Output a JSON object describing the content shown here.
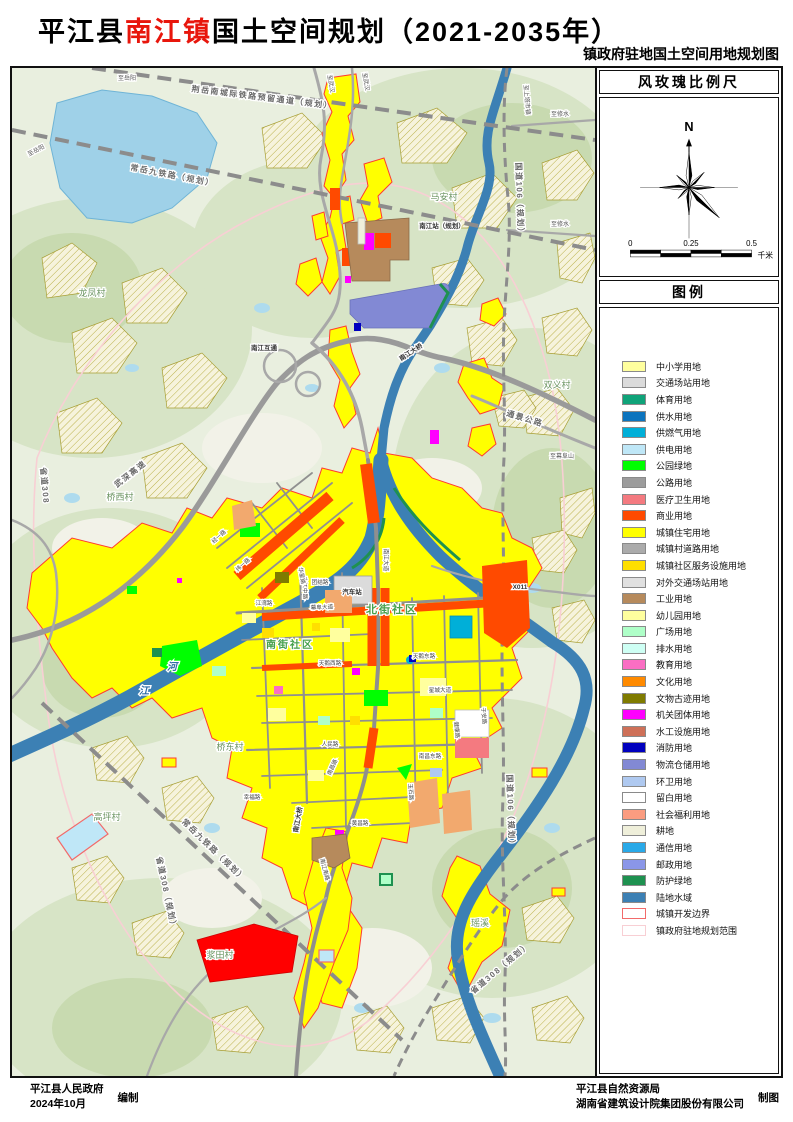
{
  "title": {
    "prefix": "平江县",
    "highlight": "南江镇",
    "suffix": "国土空间规划（2021-2035年）"
  },
  "subtitle": "镇政府驻地国土空间用地规划图",
  "sidebar": {
    "compass_header": "风玫瑰比例尺",
    "north_label": "N",
    "scale": {
      "t0": "0",
      "t1": "0.25",
      "t2": "0.5",
      "unit": "千米"
    },
    "legend_header": "图例",
    "legend_items": [
      {
        "label": "中小学用地",
        "fill": "#FFFF9E"
      },
      {
        "label": "交通场站用地",
        "fill": "#DBDBDB"
      },
      {
        "label": "体育用地",
        "fill": "#0FA379"
      },
      {
        "label": "供水用地",
        "fill": "#0C74BE"
      },
      {
        "label": "供燃气用地",
        "fill": "#00AFD8"
      },
      {
        "label": "供电用地",
        "fill": "#BFE7F7"
      },
      {
        "label": "公园绿地",
        "fill": "#00FF00"
      },
      {
        "label": "公路用地",
        "fill": "#9C9C9C"
      },
      {
        "label": "医疗卫生用地",
        "fill": "#F47A80"
      },
      {
        "label": "商业用地",
        "fill": "#FF4A00"
      },
      {
        "label": "城镇住宅用地",
        "fill": "#FFFF00"
      },
      {
        "label": "城镇村道路用地",
        "fill": "#ABABAB"
      },
      {
        "label": "城镇社区服务设施用地",
        "fill": "#FFDF00"
      },
      {
        "label": "对外交通场站用地",
        "fill": "#E0E0E0"
      },
      {
        "label": "工业用地",
        "fill": "#B68A5C"
      },
      {
        "label": "幼儿园用地",
        "fill": "#FFFF9E"
      },
      {
        "label": "广场用地",
        "fill": "#AFFFC8"
      },
      {
        "label": "排水用地",
        "fill": "#CEFFF4"
      },
      {
        "label": "教育用地",
        "fill": "#FA6EC3"
      },
      {
        "label": "文化用地",
        "fill": "#FF8A00"
      },
      {
        "label": "文物古迹用地",
        "fill": "#7F7B00"
      },
      {
        "label": "机关团体用地",
        "fill": "#FF00FF"
      },
      {
        "label": "水工设施用地",
        "fill": "#CE7058"
      },
      {
        "label": "消防用地",
        "fill": "#0000BE"
      },
      {
        "label": "物流仓储用地",
        "fill": "#8289D4"
      },
      {
        "label": "环卫用地",
        "fill": "#AFC9F0"
      },
      {
        "label": "留白用地",
        "fill": "#FFFFFF"
      },
      {
        "label": "社会福利用地",
        "fill": "#FB9C80"
      },
      {
        "label": "耕地",
        "fill": "#EFEFDA"
      },
      {
        "label": "通信用地",
        "fill": "#29A9E8"
      },
      {
        "label": "邮政用地",
        "fill": "#8A96E8"
      },
      {
        "label": "防护绿地",
        "fill": "#1E9150"
      },
      {
        "label": "陆地水域",
        "fill": "#3C80B4"
      },
      {
        "label": "城镇开发边界",
        "fill": "#FFFFFF",
        "stroke": "#F26A6A"
      },
      {
        "label": "镇政府驻地规划范围",
        "fill": "#FFFFFF",
        "stroke": "#F8CFD4"
      }
    ]
  },
  "footer": {
    "left_org": "平江县人民政府",
    "left_date": "2024年10月",
    "left_role": "编制",
    "right_org1": "平江县自然资源局",
    "right_org2": "湖南省建筑设计院集团股份有限公司",
    "right_role": "制图"
  },
  "map": {
    "labels": [
      {
        "t": "龙凤村",
        "x": 80,
        "y": 228,
        "c": "v"
      },
      {
        "t": "桥西村",
        "x": 108,
        "y": 432,
        "c": "v"
      },
      {
        "t": "马安村",
        "x": 432,
        "y": 132,
        "c": "v"
      },
      {
        "t": "双义村",
        "x": 545,
        "y": 320,
        "c": "v"
      },
      {
        "t": "桥东村",
        "x": 218,
        "y": 682,
        "c": "v"
      },
      {
        "t": "高坪村",
        "x": 95,
        "y": 752,
        "c": "v"
      },
      {
        "t": "浆田村",
        "x": 208,
        "y": 890,
        "c": "v"
      },
      {
        "t": "瑶溪",
        "x": 468,
        "y": 858,
        "c": "v"
      },
      {
        "t": "北街社区",
        "x": 380,
        "y": 545,
        "c": "c"
      },
      {
        "t": "南街社区",
        "x": 278,
        "y": 580,
        "c": "c",
        "s": 10
      },
      {
        "t": "河",
        "x": 160,
        "y": 602,
        "c": "w"
      },
      {
        "t": "江",
        "x": 132,
        "y": 626,
        "c": "w"
      },
      {
        "t": "幕阜大道",
        "x": 310,
        "y": 541,
        "c": "r",
        "r": -2
      },
      {
        "t": "南江大道",
        "x": 372,
        "y": 492,
        "c": "r",
        "r": 90
      },
      {
        "t": "南江中路",
        "x": 291,
        "y": 520,
        "c": "r",
        "r": 88
      },
      {
        "t": "天鹅西路",
        "x": 318,
        "y": 597,
        "c": "r"
      },
      {
        "t": "天鹅东路",
        "x": 412,
        "y": 590,
        "c": "r"
      },
      {
        "t": "星城大道",
        "x": 428,
        "y": 624,
        "c": "r"
      },
      {
        "t": "健康路",
        "x": 443,
        "y": 662,
        "c": "r",
        "r": 85
      },
      {
        "t": "南昌东路",
        "x": 418,
        "y": 690,
        "c": "r"
      },
      {
        "t": "南昌路",
        "x": 322,
        "y": 700,
        "c": "r",
        "r": -65
      },
      {
        "t": "人民路",
        "x": 318,
        "y": 678,
        "c": "r"
      },
      {
        "t": "玉石路",
        "x": 397,
        "y": 724,
        "c": "r",
        "r": 87
      },
      {
        "t": "黄昌路",
        "x": 348,
        "y": 757,
        "c": "r"
      },
      {
        "t": "幸福路",
        "x": 240,
        "y": 731,
        "c": "r"
      },
      {
        "t": "团结路",
        "x": 308,
        "y": 516,
        "c": "r"
      },
      {
        "t": "华星路",
        "x": 288,
        "y": 508,
        "c": "r",
        "r": 80
      },
      {
        "t": "江湾路",
        "x": 252,
        "y": 537,
        "c": "r"
      },
      {
        "t": "经一路",
        "x": 208,
        "y": 470,
        "c": "r",
        "r": -42
      },
      {
        "t": "纬一路",
        "x": 232,
        "y": 498,
        "c": "r",
        "r": -42
      },
      {
        "t": "于安路",
        "x": 470,
        "y": 648,
        "c": "r",
        "r": 85
      },
      {
        "t": "南江南路",
        "x": 311,
        "y": 802,
        "c": "r",
        "r": 75
      },
      {
        "t": "汽车站",
        "x": 340,
        "y": 526,
        "c": "t"
      },
      {
        "t": "南江站（规划）",
        "x": 430,
        "y": 160,
        "c": "t"
      },
      {
        "t": "南江互通",
        "x": 252,
        "y": 282,
        "c": "t"
      },
      {
        "t": "南江大桥",
        "x": 400,
        "y": 286,
        "c": "t",
        "r": -33
      },
      {
        "t": "南江大桥",
        "x": 288,
        "y": 752,
        "c": "t",
        "r": -80
      },
      {
        "t": "X011",
        "x": 508,
        "y": 521,
        "c": "t"
      },
      {
        "t": "武深高速",
        "x": 120,
        "y": 408,
        "c": "rl",
        "r": -38
      },
      {
        "t": "通景公路",
        "x": 512,
        "y": 353,
        "c": "rl",
        "r": 17
      },
      {
        "t": "省道308",
        "x": 30,
        "y": 418,
        "c": "rl",
        "r": 85
      },
      {
        "t": "省道308（规划）",
        "x": 152,
        "y": 826,
        "c": "rl",
        "r": 78
      },
      {
        "t": "省道308（规划）",
        "x": 490,
        "y": 902,
        "c": "rl",
        "r": -40
      },
      {
        "t": "国道106（规划）",
        "x": 505,
        "y": 132,
        "c": "rl",
        "r": 88
      },
      {
        "t": "国道106（规划）",
        "x": 496,
        "y": 744,
        "c": "rl",
        "r": 88
      },
      {
        "t": "荆岳南城际铁路预留通道（规划）",
        "x": 250,
        "y": 32,
        "c": "rl",
        "r": 7
      },
      {
        "t": "常岳九铁路（规划）",
        "x": 160,
        "y": 110,
        "c": "rl",
        "r": 11
      },
      {
        "t": "常岳九铁路（规划）",
        "x": 200,
        "y": 784,
        "c": "rl",
        "r": 44
      },
      {
        "t": "至岳阳",
        "x": 115,
        "y": 12,
        "c": "d"
      },
      {
        "t": "至岳阳",
        "x": 25,
        "y": 84,
        "c": "d",
        "r": -28
      },
      {
        "t": "至武汉",
        "x": 317,
        "y": 16,
        "c": "d",
        "r": 80
      },
      {
        "t": "至武汉",
        "x": 352,
        "y": 14,
        "c": "d",
        "r": 80
      },
      {
        "t": "至修水",
        "x": 548,
        "y": 48,
        "c": "d"
      },
      {
        "t": "至修水",
        "x": 548,
        "y": 158,
        "c": "d"
      },
      {
        "t": "至幕阜山",
        "x": 550,
        "y": 390,
        "c": "d"
      },
      {
        "t": "至上塔市镇",
        "x": 513,
        "y": 32,
        "c": "d",
        "r": 85
      }
    ]
  }
}
